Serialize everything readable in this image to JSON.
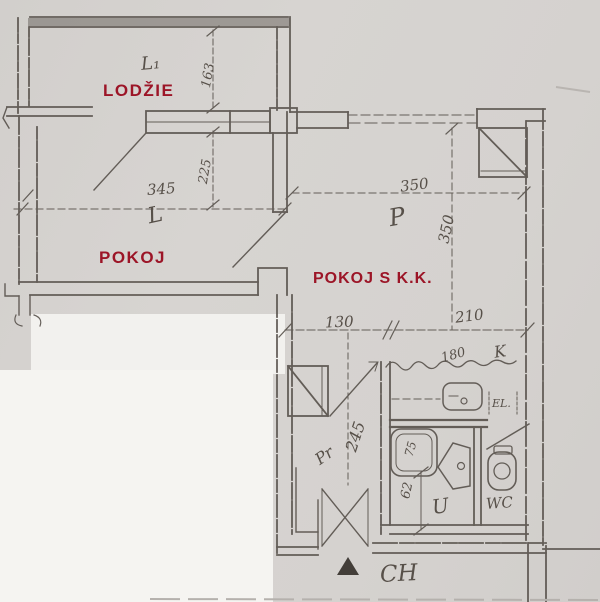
{
  "plan_type": "apartment floor plan scan",
  "colors": {
    "room_label_red": "#9c1527",
    "drawing_ink": "#57514b",
    "paper": "#d5d2cf",
    "white_patch": "#f4f3f0"
  },
  "rooms": {
    "lodzie": {
      "label": "LODŽIE",
      "code": "L₁"
    },
    "pokoj": {
      "label": "POKOJ",
      "code": "L"
    },
    "pokoj_s_kk": {
      "label": "POKOJ S K.K.",
      "code": "P"
    },
    "hall": {
      "code": "Pr"
    },
    "bath": {
      "code": "U"
    },
    "wc": {
      "code": "WC"
    },
    "corridor": {
      "code": "CH"
    },
    "kitchen_counter": {
      "code": "K"
    }
  },
  "notes": {
    "electrical": "EL."
  },
  "dimensions_cm": {
    "loggia_depth": "163",
    "loggia_window": "225",
    "pokoj_width": "345",
    "room_width": "350",
    "room_depth": "350",
    "hall_width": "130",
    "kitchen_width": "210",
    "hall_depth": "245",
    "counter_length": "180",
    "tub_width": "75",
    "bath_clearance": "62"
  }
}
